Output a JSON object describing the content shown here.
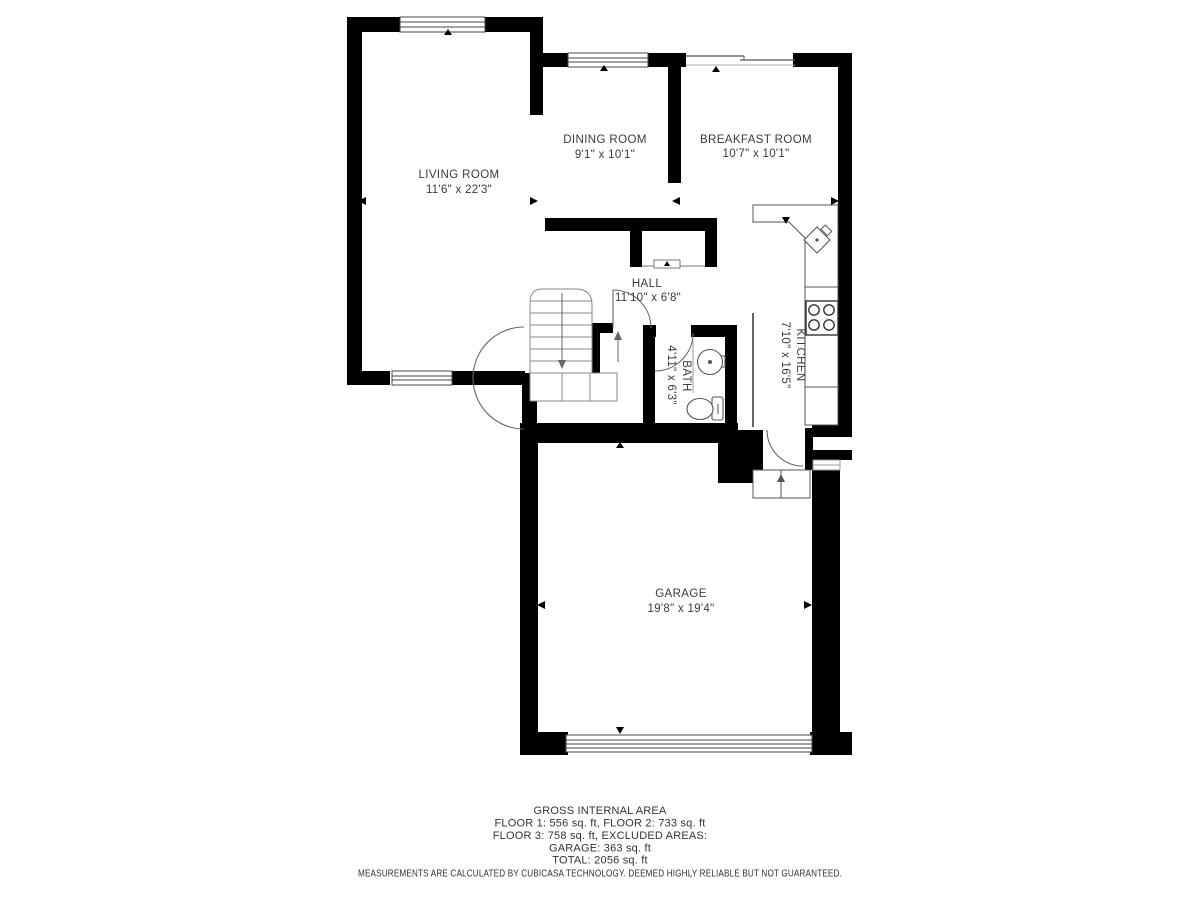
{
  "rooms": {
    "living": {
      "name": "LIVING ROOM",
      "dims": "11'6\" x 22'3\""
    },
    "dining": {
      "name": "DINING ROOM",
      "dims": "9'1\" x 10'1\""
    },
    "breakfast": {
      "name": "BREAKFAST ROOM",
      "dims": "10'7\" x 10'1\""
    },
    "hall": {
      "name": "HALL",
      "dims": "11'10\" x 6'8\""
    },
    "bath": {
      "name": "BATH",
      "dims": "4'11\" x 6'3\""
    },
    "kitchen": {
      "name": "KITCHEN",
      "dims": "7'10\" x 16'5\""
    },
    "garage": {
      "name": "GARAGE",
      "dims": "19'8\" x 19'4\""
    }
  },
  "footer": {
    "title": "GROSS INTERNAL AREA",
    "line1": "FLOOR 1: 556 sq. ft, FLOOR 2: 733 sq. ft",
    "line2": "FLOOR 3: 758 sq. ft, EXCLUDED AREAS:",
    "line3": "GARAGE: 363 sq. ft",
    "line4": "TOTAL: 2056 sq. ft",
    "disclaimer": "MEASUREMENTS ARE CALCULATED BY CUBICASA TECHNOLOGY. DEEMED HIGHLY RELIABLE BUT NOT GUARANTEED."
  },
  "colors": {
    "wall": "#000000",
    "line": "#555555",
    "text": "#3b3b3b"
  }
}
